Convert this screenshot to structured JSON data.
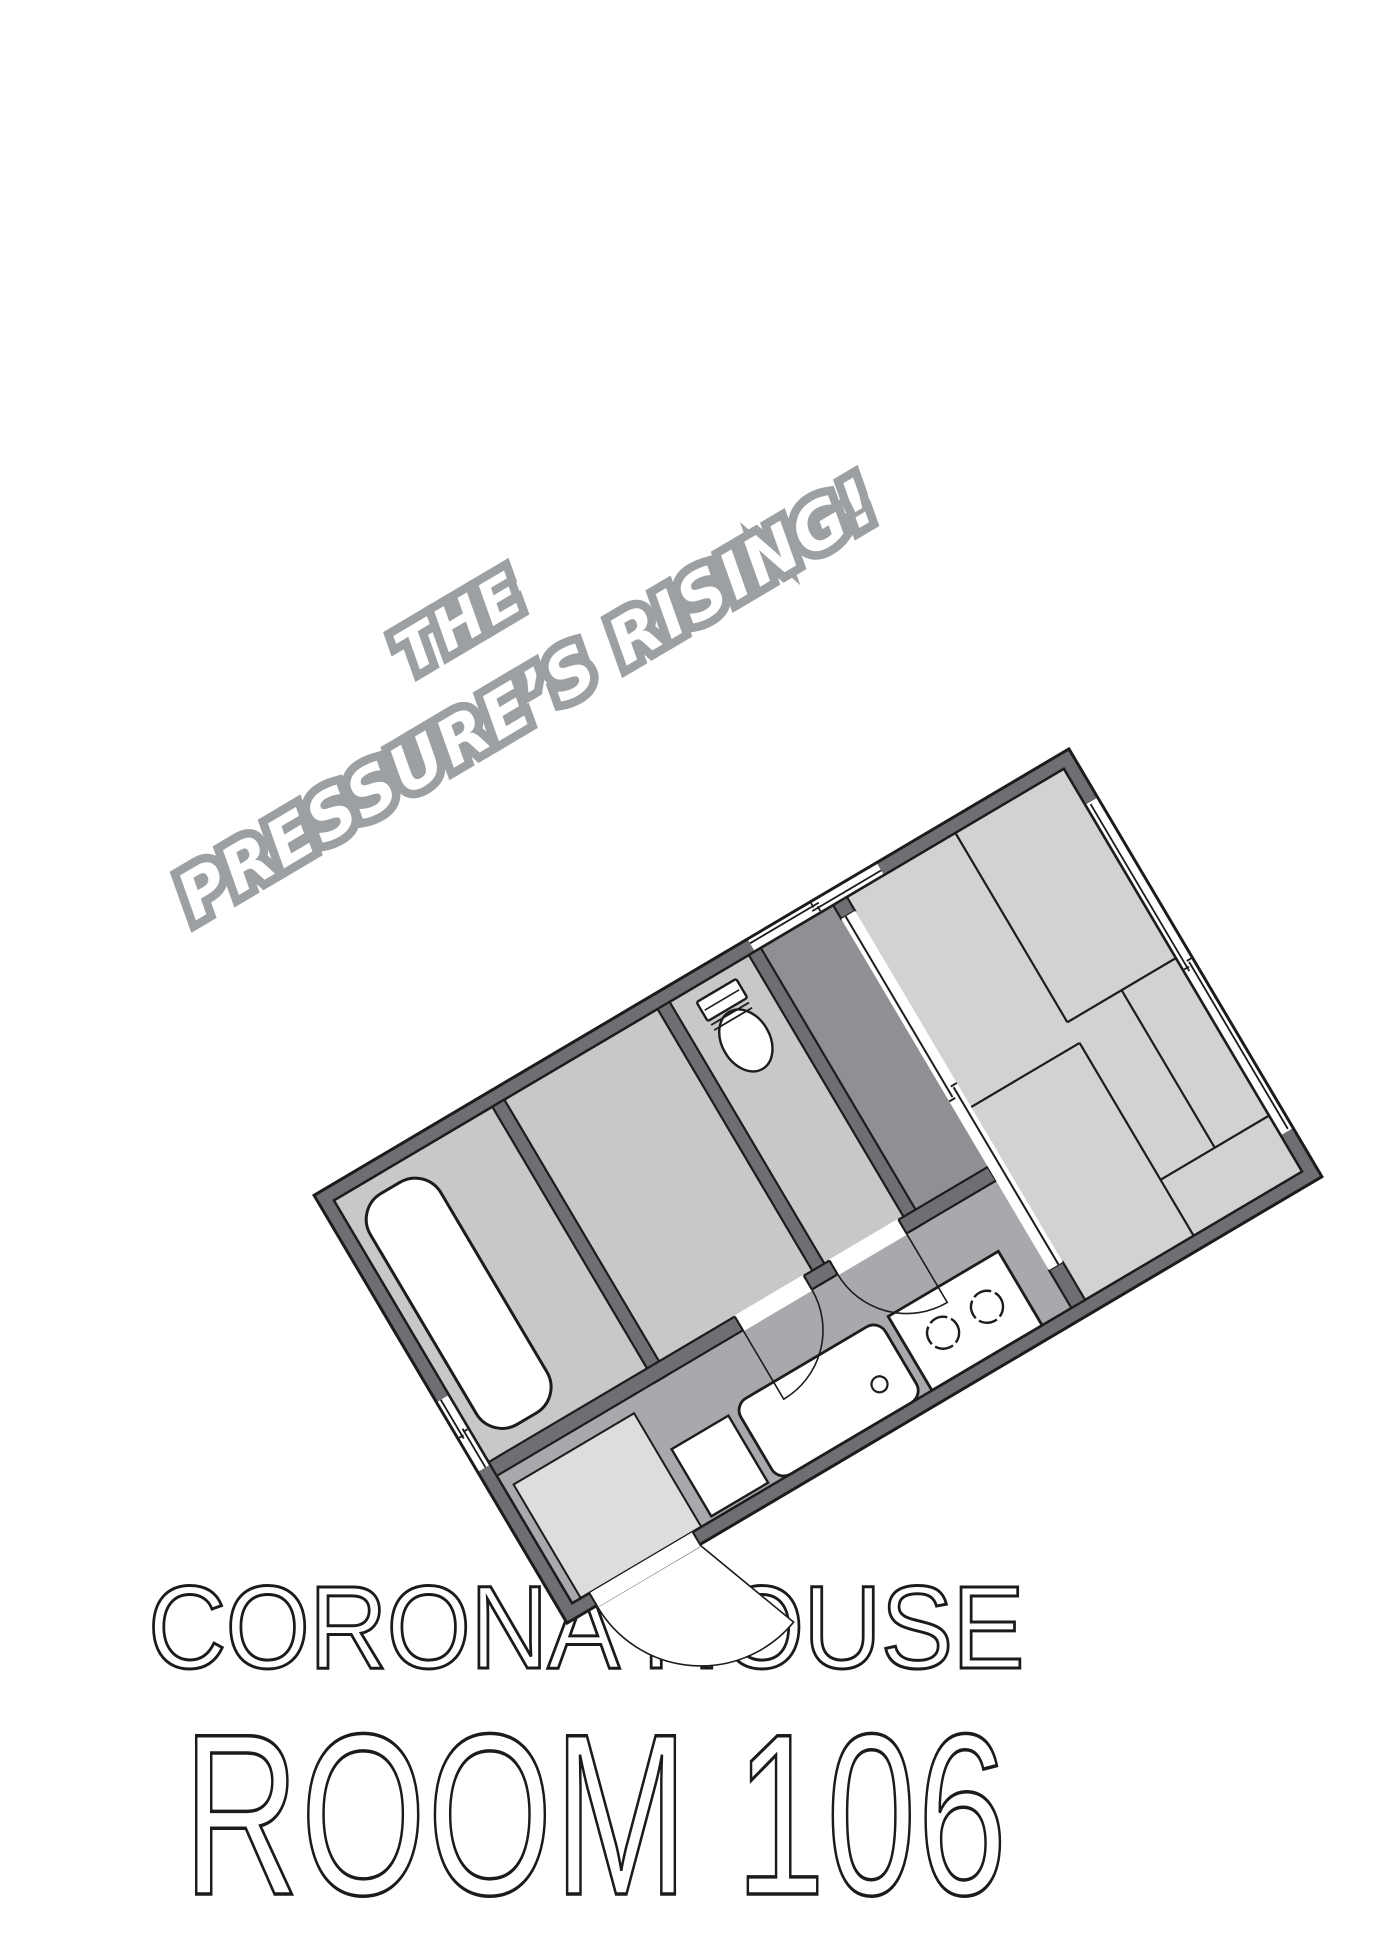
{
  "title": {
    "line1": "THE",
    "line2": "PRESSURE’S RISING!"
  },
  "building": {
    "name": "CORONA HOUSE",
    "room_label": "ROOM 106"
  },
  "floorplan": {
    "type": "apartment-floor-plan",
    "rotation_deg": -30.6,
    "features": [
      "bathtub",
      "bathroom",
      "washroom",
      "toilet",
      "closet",
      "sliding-door",
      "tatami-room-6-mats",
      "hallway-kitchen",
      "kitchen-sink",
      "gas-stove",
      "washing-machine-pan",
      "entrance-genkan",
      "entry-door-swing",
      "interior-door-swings",
      "window-left-wall",
      "window-top-wall",
      "window-right-wall"
    ]
  },
  "colors": {
    "wall": "#6d6f73",
    "outline": "#9da0a3",
    "room": "#c6c8ca",
    "tatami": "#d0d2d4",
    "hall": "#a7a9ac",
    "closet": "#8e9094",
    "genkan": "#dcdddd",
    "line": "#1c1c1c",
    "text": "#1b1b1b"
  }
}
